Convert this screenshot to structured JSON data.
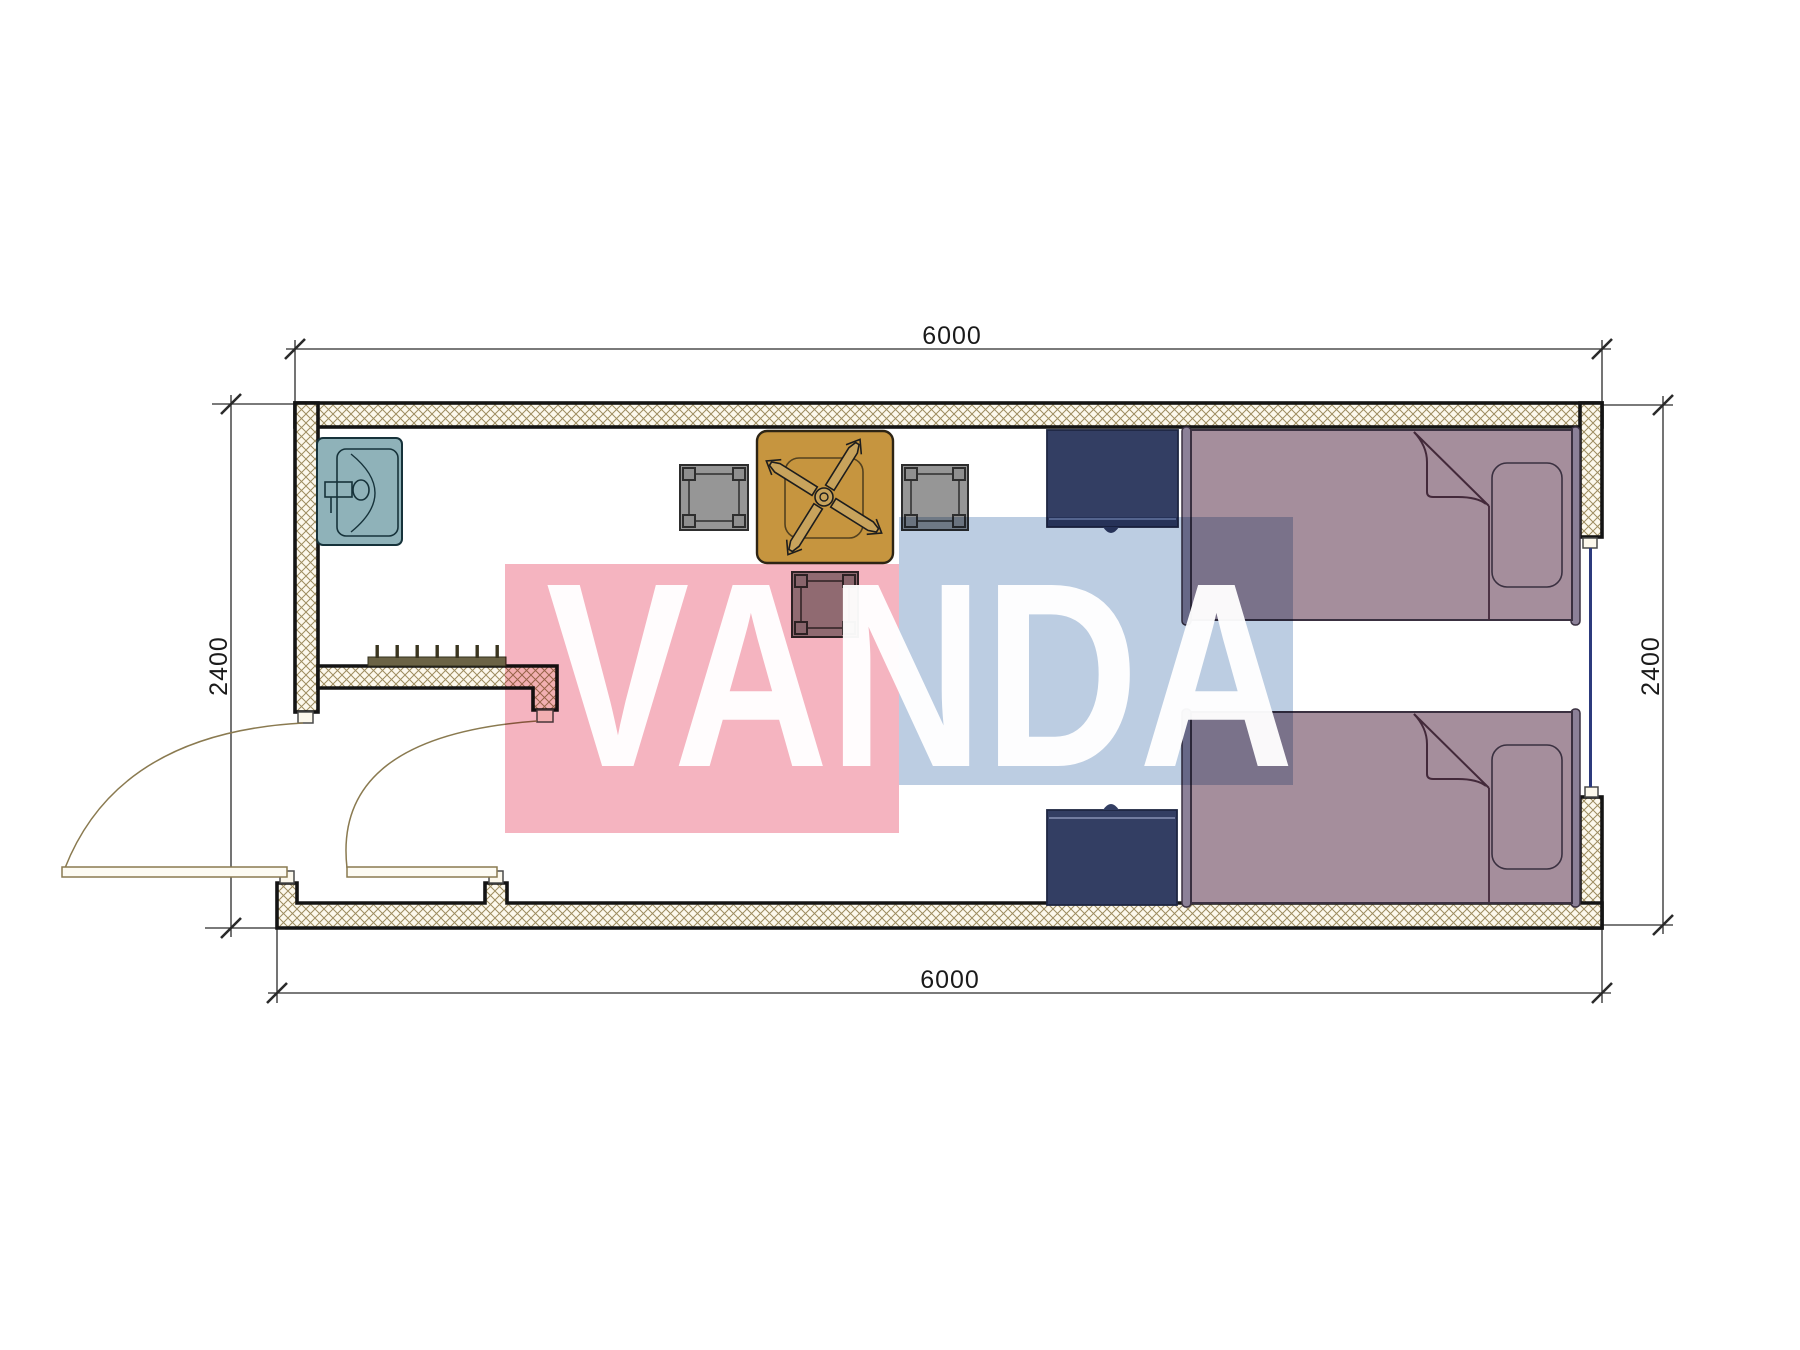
{
  "plan": {
    "title": "container-room-floor-plan",
    "dimensions": {
      "top_width_mm": "6000",
      "bottom_width_mm": "6000",
      "left_height_mm": "2400",
      "right_height_mm": "2400"
    }
  },
  "watermark": {
    "text": "VANDA",
    "pink": "#f5b4c0",
    "blue": "#bccde2",
    "text_color": "#ffffff"
  },
  "icons": {
    "sink": "sink-icon",
    "ceiling_fan": "ceiling-fan-icon",
    "door_swing": "door-swing-icon",
    "coat_hooks": "coat-hook-rail-icon",
    "window": "window-icon"
  },
  "colors": {
    "page_bg": "#ffffff",
    "wall_fill": "#fcf8ec",
    "wall_hatch": "#9d8c5f",
    "wall_outline": "#141414",
    "dim_line": "#2a2a2a",
    "dim_text": "#1a1a1a",
    "door": "#8a7a50",
    "door_leaf_fill": "#fdfbf3",
    "hook_rail": "#6b6345",
    "hook_teeth": "#3a351f",
    "window": "#2c3a7d",
    "sink": "#8fb2b9",
    "sink_line": "#16323a",
    "table": "#c6953f",
    "table_line": "#2d2414",
    "fan_blade": "#c8a35c",
    "chair": "#969696",
    "chair_line": "#2e2e2e",
    "nightstand": "#333e63",
    "nightstand_line": "#8791b5",
    "bed": "#a58e9c",
    "bed_frame": "#8c8198",
    "bed_line": "#3a3040",
    "fold_line": "#43293a",
    "jamb_fill": "#fcf8ec"
  }
}
